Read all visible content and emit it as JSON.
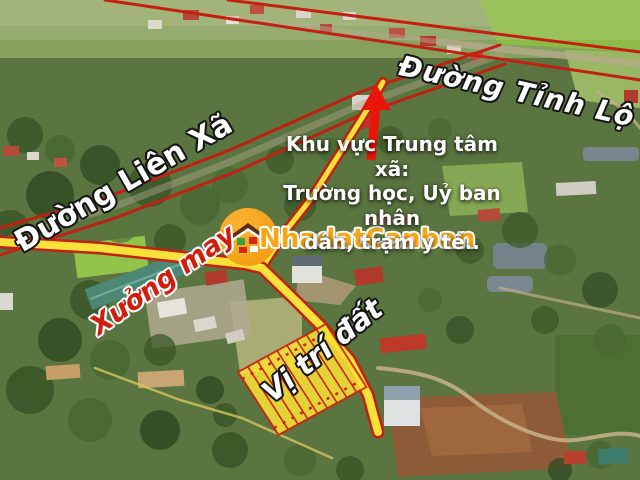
{
  "image_type": "annotated aerial real-estate location photo",
  "annotations": {
    "road_provincial": "Đường Tỉnh Lộ 5",
    "road_commune": "Đường Liên Xã",
    "center_note": [
      "Khu vực Trung tâm xã:",
      "Trường học, Uỷ ban nhân",
      "dân, trạm y tế.."
    ],
    "factory": "Xưởng may",
    "plot": "Vị trí đất"
  },
  "watermark": {
    "brand": "NhadatCanban",
    "suffix": "com.vn",
    "icon": "house-in-circle-icon"
  },
  "icons": {
    "arrow": "red-up-arrow-icon",
    "logo": "house-logo-icon"
  },
  "colors": {
    "road_outline_red": "#c22012",
    "highlight_yellow": "#f8e23a",
    "parcel_divider_red": "#cc2210",
    "arrow_red": "#e81508",
    "brand_orange": "#f7a716",
    "factory_label_red": "#d01d0e",
    "label_white": "#ffffff"
  }
}
